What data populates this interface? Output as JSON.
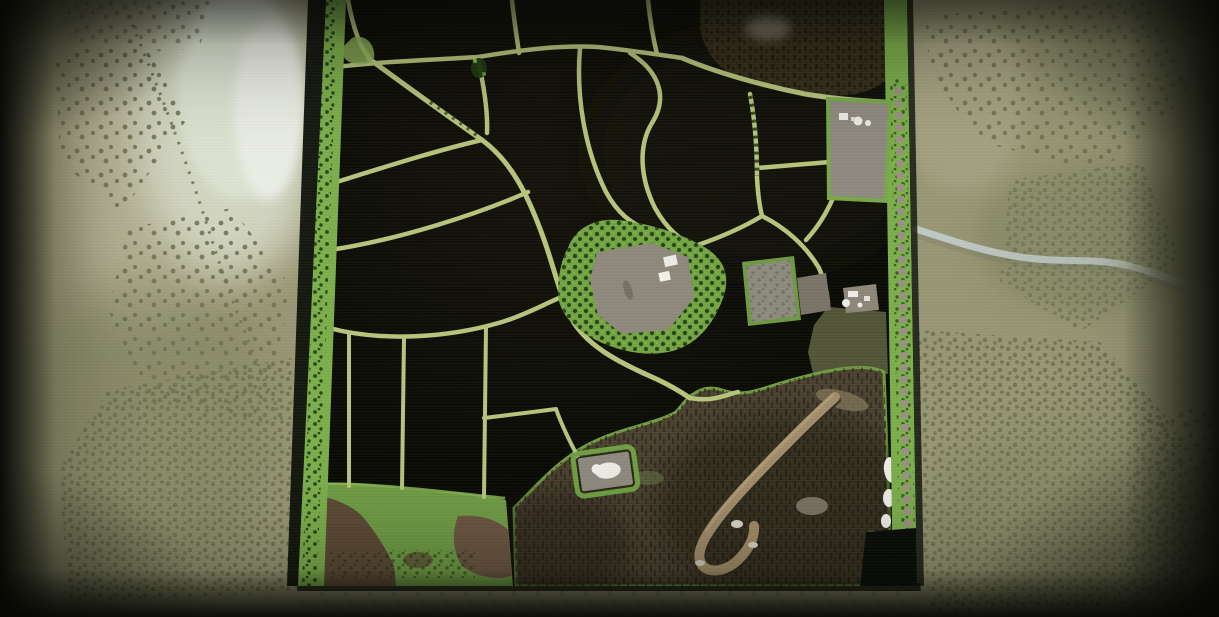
{
  "meta": {
    "title": "Farming game map overview",
    "view": "top-down satellite farm map on paper-style background",
    "width_px": 1219,
    "height_px": 617,
    "visible_text": "none"
  },
  "scene": {
    "description": "Aerial overview map of a farming area: dark harvested fields divided by light green field roads, a central farmstead with gray yard and white buildings, a northeast forest, equipment lots, a southwest grass meadow with dirt patches, and southeast rough terrain with a hook-shaped dirt track. The map sits on an olive paper background with tree-dot clusters, a pale lake glow at the top left and a small river leaving the map to the east.",
    "regions": [
      {
        "name": "paper-background",
        "label": "paper map background with tree dot clusters"
      },
      {
        "name": "lake-glow",
        "label": "pale lake area top-left"
      },
      {
        "name": "river",
        "label": "small river flowing east off the map"
      },
      {
        "name": "game-map",
        "label": "playable satellite map area"
      },
      {
        "name": "forest-northeast",
        "label": "dark forest block"
      },
      {
        "name": "farmstead-central",
        "label": "main farm with gray yard and white buildings"
      },
      {
        "name": "lot-northeast",
        "label": "gray equipment yard with silos"
      },
      {
        "name": "lots-middle-east",
        "label": "small gray lots and farm cluster"
      },
      {
        "name": "parking-south",
        "label": "small yard with white building"
      },
      {
        "name": "grass-southwest",
        "label": "meadow with dirt patches"
      },
      {
        "name": "rough-terrain-southeast",
        "label": "rough terrain with hook-shaped track"
      },
      {
        "name": "boundary-strips",
        "label": "green tree boundary strips on west and east edges"
      }
    ]
  },
  "colors": {
    "paper": "#989674",
    "paper-light": "#b9b599",
    "paper-blotch": "#7e815f",
    "dot": "#6f7452",
    "lake": "#dde3d2",
    "lake-core": "#ecefe6",
    "river": "#c0cac7",
    "field": "#0b0b06",
    "field2": "#14120a",
    "road": "#b6c47c",
    "road-bright": "#ccd68e",
    "strip": "#7cae4b",
    "tree-dark": "#1f3a10",
    "tree-bright": "#7fbf3f",
    "forest": "#342d1b",
    "forest-tex": "#1e180c",
    "olive": "#565839",
    "rough": "#4a4130",
    "rough-dark": "#272114",
    "track": "#a18c69",
    "track-shadow": "#2e2920",
    "grass": "#6f9c45",
    "dirt": "#5c4935",
    "dirt2": "#6b5541",
    "farm-green": "#72a343",
    "yard": "#8e897c",
    "lot": "#8f8a80",
    "white": "#edece6",
    "rock": "#9a9183",
    "edge-dark": "#0d110a"
  }
}
